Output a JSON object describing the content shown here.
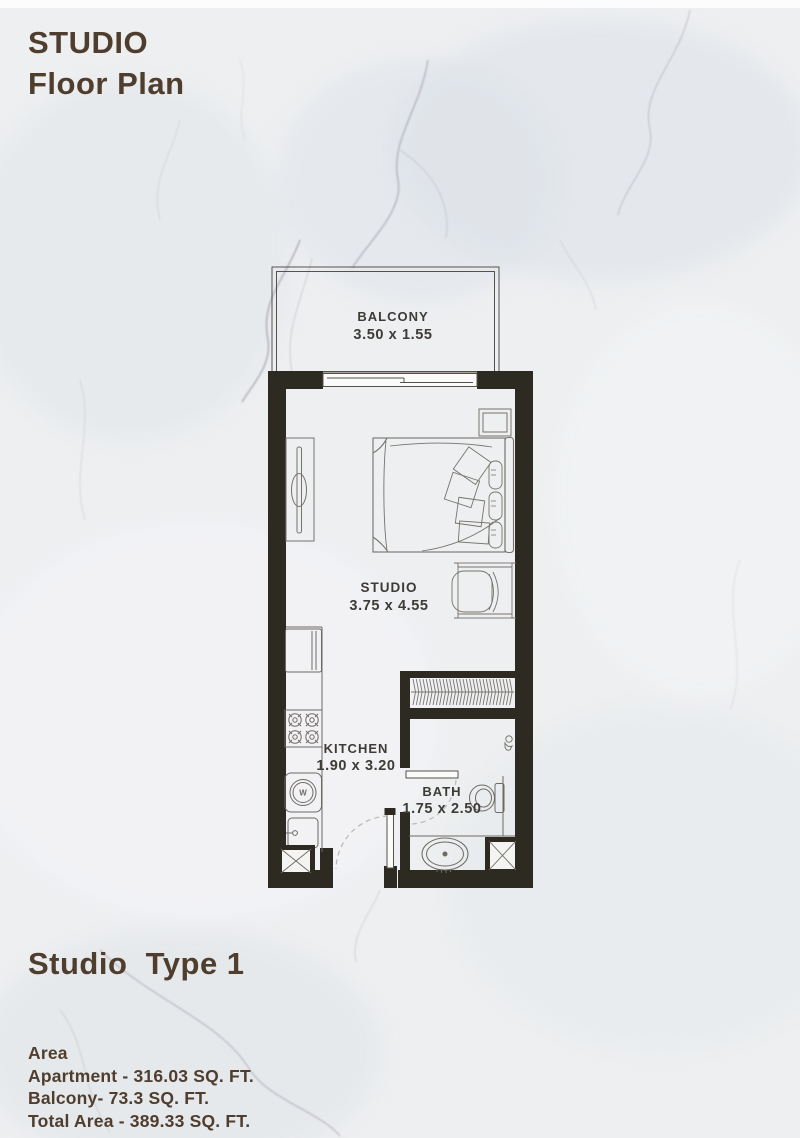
{
  "header": {
    "title_line1": "STUDIO",
    "title_line2": "Floor Plan"
  },
  "plan": {
    "balcony": {
      "label": "BALCONY",
      "dims": "3.50 x 1.55"
    },
    "studio": {
      "label": "STUDIO",
      "dims": "3.75 x 4.55"
    },
    "kitchen": {
      "label": "KITCHEN",
      "dims": "1.90 x 3.20",
      "washer_label": "W"
    },
    "bath": {
      "label": "BATH",
      "dims": "1.75 x 2.50"
    }
  },
  "footer": {
    "type_label": "Studio  Type 1",
    "area_heading": "Area",
    "area_lines": [
      "Apartment - 316.03 SQ. FT.",
      "Balcony- 73.3 SQ. FT.",
      "Total Area - 389.33 SQ. FT."
    ]
  },
  "colors": {
    "wall": "#2d2a21",
    "furniture_line": "#6e6a63",
    "label_text": "#3d3b36",
    "title_text": "#4f3d2e",
    "background": "#edeff1"
  }
}
